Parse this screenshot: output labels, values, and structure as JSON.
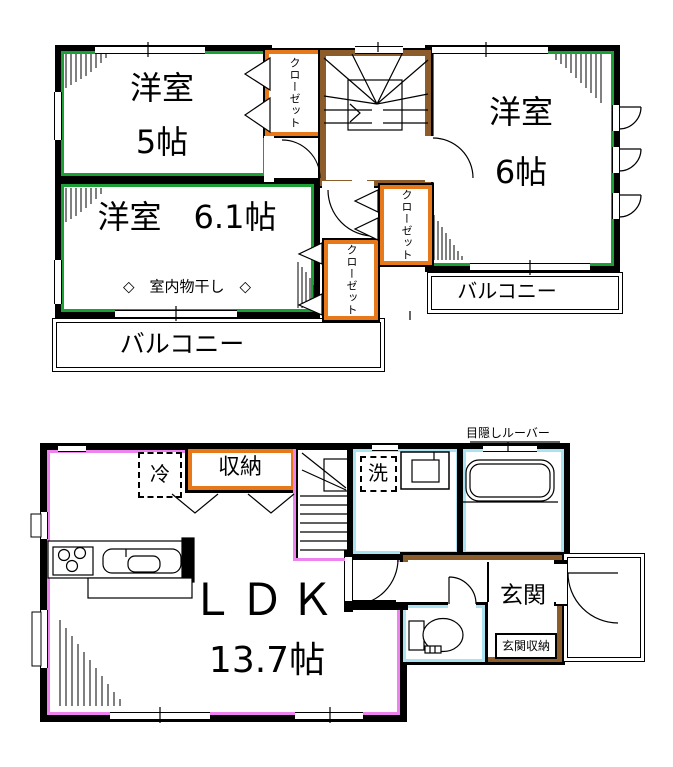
{
  "colors": {
    "wall": "#000000",
    "room_green": "#1C9F35",
    "closet_orange": "#E8791B",
    "stairs_brown": "#8C5D2B",
    "ldk_pink": "#EE82EE",
    "bath_cyan": "#A9E2F0"
  },
  "floor2": {
    "room5": {
      "name": "洋室",
      "size": "5帖"
    },
    "room6": {
      "name": "洋室",
      "size": "6帖"
    },
    "room61": {
      "label": "洋室　6.1帖",
      "note": "◇　室内物干し　◇"
    },
    "closet": "クローゼット",
    "balcony": "バルコニー"
  },
  "floor1": {
    "ldk": {
      "name": "ＬＤＫ",
      "size": "13.7帖"
    },
    "fridge": "冷",
    "storage": "収納",
    "laundry": "洗",
    "entrance": "玄関",
    "entrance_storage": "玄関収納",
    "louver_note": "目隠しルーバー"
  }
}
